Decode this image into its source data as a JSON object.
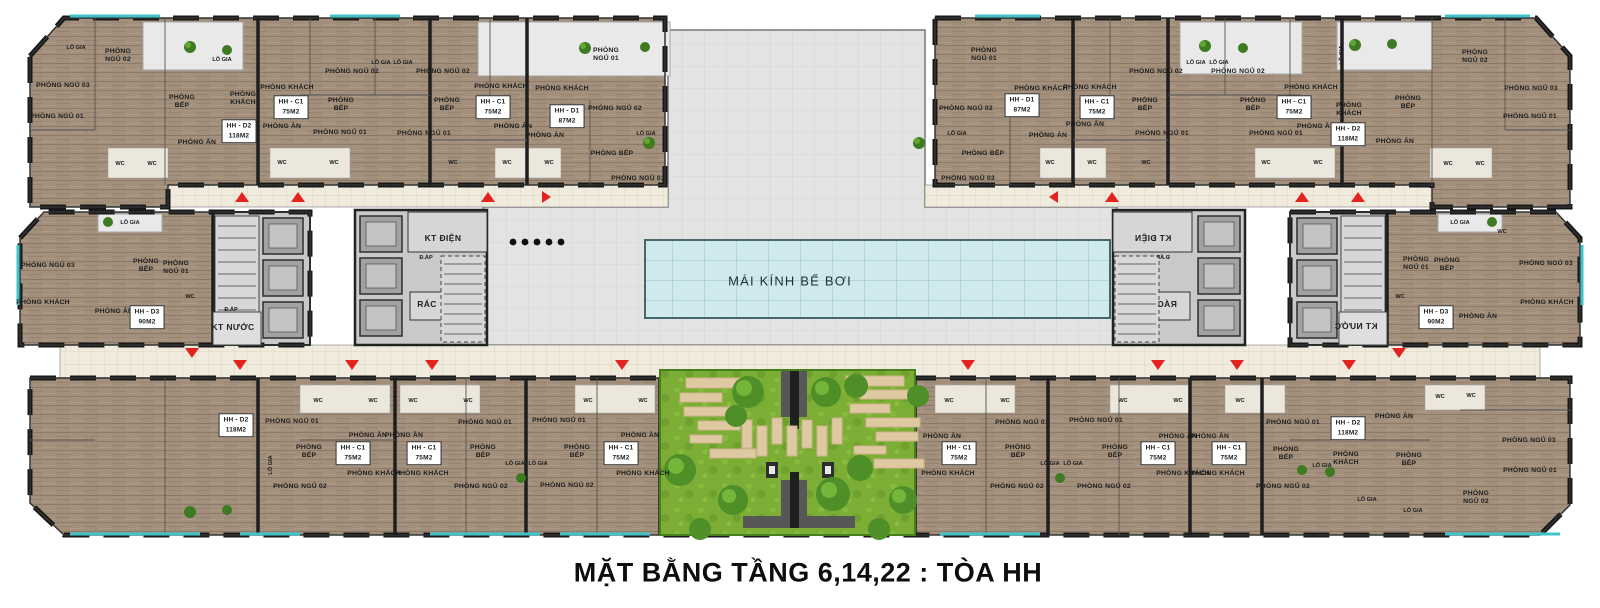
{
  "title": {
    "caption": "MẶT BẰNG TẦNG 6,14,22 : TÒA HH"
  },
  "building": "TÒA HH",
  "floors_shown": "6,14,22",
  "unit_types": [
    {
      "code": "HH - C1",
      "area": "75M2"
    },
    {
      "code": "HH - D1",
      "area": "87M2"
    },
    {
      "code": "HH - D2",
      "area": "118M2"
    },
    {
      "code": "HH - D3",
      "area": "90M2"
    }
  ],
  "colors": {
    "apartment_floor": "#a3907c",
    "corridor_tile": "#f0ebdc",
    "wall": "#1e1e1e",
    "deck": "#e3e3e4",
    "pool_glass": "#cfe9ec",
    "garden_grass": "#7cae35",
    "paver": "#dfc9a2",
    "balcony_accent": "#3fc3c8",
    "entrance_arrow": "#e42320",
    "core_floor": "#c9c9c9"
  },
  "labels": [
    {
      "t": "LÔ GIA",
      "x": 76,
      "y": 48,
      "s": "xs"
    },
    {
      "t": "PHÒNG\nNGỦ 02",
      "x": 118,
      "y": 56
    },
    {
      "t": "PHÒNG NGỦ 03",
      "x": 63,
      "y": 86
    },
    {
      "t": "PHÒNG NGỦ 01",
      "x": 57,
      "y": 117
    },
    {
      "t": "PHÒNG\nBẾP",
      "x": 182,
      "y": 102
    },
    {
      "t": "PHÒNG\nKHÁCH",
      "x": 243,
      "y": 99
    },
    {
      "t": "PHÒNG ĂN",
      "x": 197,
      "y": 143
    },
    {
      "t": "HH - D2\n118M2",
      "x": 239,
      "y": 131,
      "box": 1
    },
    {
      "t": "WC",
      "x": 120,
      "y": 164,
      "s": "xs"
    },
    {
      "t": "WC",
      "x": 152,
      "y": 164,
      "s": "xs"
    },
    {
      "t": "LÔ GIA",
      "x": 222,
      "y": 60,
      "s": "xs"
    },
    {
      "t": "PHÒNG KHÁCH",
      "x": 287,
      "y": 88
    },
    {
      "t": "HH - C1\n75M2",
      "x": 291,
      "y": 107,
      "box": 1
    },
    {
      "t": "PHÒNG ĂN",
      "x": 282,
      "y": 127
    },
    {
      "t": "PHÒNG\nBẾP",
      "x": 341,
      "y": 105
    },
    {
      "t": "PHÒNG NGỦ 02",
      "x": 352,
      "y": 72
    },
    {
      "t": "PHÒNG NGỦ 01",
      "x": 340,
      "y": 133
    },
    {
      "t": "LÔ GIA",
      "x": 381,
      "y": 63,
      "s": "xs"
    },
    {
      "t": "WC",
      "x": 282,
      "y": 163,
      "s": "xs"
    },
    {
      "t": "WC",
      "x": 334,
      "y": 163,
      "s": "xs"
    },
    {
      "t": "LÔ GIA",
      "x": 403,
      "y": 63,
      "s": "xs"
    },
    {
      "t": "PHÒNG NGỦ 02",
      "x": 443,
      "y": 72
    },
    {
      "t": "PHÒNG KHÁCH",
      "x": 501,
      "y": 87
    },
    {
      "t": "HH - C1\n75M2",
      "x": 493,
      "y": 107,
      "box": 1
    },
    {
      "t": "PHÒNG\nBẾP",
      "x": 447,
      "y": 105
    },
    {
      "t": "PHÒNG ĂN",
      "x": 513,
      "y": 127
    },
    {
      "t": "PHÒNG NGỦ 01",
      "x": 424,
      "y": 134
    },
    {
      "t": "WC",
      "x": 453,
      "y": 163,
      "s": "xs"
    },
    {
      "t": "WC",
      "x": 507,
      "y": 163,
      "s": "xs"
    },
    {
      "t": "WC",
      "x": 549,
      "y": 163,
      "s": "xs"
    },
    {
      "t": "PHÒNG KHÁCH",
      "x": 562,
      "y": 89
    },
    {
      "t": "HH - D1\n87M2",
      "x": 567,
      "y": 116,
      "box": 1
    },
    {
      "t": "PHÒNG ĂN",
      "x": 545,
      "y": 136
    },
    {
      "t": "PHÒNG\nNGỦ 01",
      "x": 606,
      "y": 55
    },
    {
      "t": "PHÒNG NGỦ 02",
      "x": 615,
      "y": 109
    },
    {
      "t": "LÔ GIA",
      "x": 646,
      "y": 134,
      "s": "xs"
    },
    {
      "t": "PHÒNG BẾP",
      "x": 612,
      "y": 154
    },
    {
      "t": "PHÒNG NGỦ 03",
      "x": 638,
      "y": 179
    },
    {
      "t": "PHÒNG\nNGỦ 01",
      "x": 984,
      "y": 55
    },
    {
      "t": "PHÒNG NGỦ 02",
      "x": 966,
      "y": 109
    },
    {
      "t": "PHÒNG BẾP",
      "x": 983,
      "y": 154
    },
    {
      "t": "PHÒNG NGỦ 03",
      "x": 968,
      "y": 179
    },
    {
      "t": "PHÒNG KHÁCH",
      "x": 1041,
      "y": 89
    },
    {
      "t": "HH - D1\n87M2",
      "x": 1022,
      "y": 105,
      "box": 1
    },
    {
      "t": "PHÒNG ĂN",
      "x": 1048,
      "y": 136
    },
    {
      "t": "LÔ GIA",
      "x": 957,
      "y": 134,
      "s": "xs"
    },
    {
      "t": "PHÒNG KHÁCH",
      "x": 1090,
      "y": 88
    },
    {
      "t": "HH - C1\n75M2",
      "x": 1097,
      "y": 107,
      "box": 1
    },
    {
      "t": "PHÒNG ĂN",
      "x": 1085,
      "y": 125
    },
    {
      "t": "PHÒNG NGỦ 02",
      "x": 1156,
      "y": 72
    },
    {
      "t": "PHÒNG\nBẾP",
      "x": 1145,
      "y": 105
    },
    {
      "t": "PHÒNG NGỦ 01",
      "x": 1162,
      "y": 134
    },
    {
      "t": "WC",
      "x": 1050,
      "y": 163,
      "s": "xs"
    },
    {
      "t": "WC",
      "x": 1092,
      "y": 163,
      "s": "xs"
    },
    {
      "t": "WC",
      "x": 1146,
      "y": 163,
      "s": "xs"
    },
    {
      "t": "LÔ GIA",
      "x": 1196,
      "y": 63,
      "s": "xs"
    },
    {
      "t": "PHÒNG NGỦ 02",
      "x": 1238,
      "y": 72
    },
    {
      "t": "PHÒNG\nBẾP",
      "x": 1253,
      "y": 105
    },
    {
      "t": "PHÒNG KHÁCH",
      "x": 1311,
      "y": 88
    },
    {
      "t": "HH - C1\n75M2",
      "x": 1294,
      "y": 107,
      "box": 1
    },
    {
      "t": "PHÒNG ĂN",
      "x": 1316,
      "y": 127
    },
    {
      "t": "PHÒNG NGỦ 01",
      "x": 1276,
      "y": 134
    },
    {
      "t": "WC",
      "x": 1266,
      "y": 163,
      "s": "xs"
    },
    {
      "t": "WC",
      "x": 1318,
      "y": 163,
      "s": "xs"
    },
    {
      "t": "LÔ GIA",
      "x": 1219,
      "y": 63,
      "s": "xs"
    },
    {
      "t": "PHÒNG\nKHÁCH",
      "x": 1349,
      "y": 110
    },
    {
      "t": "HH - D2\n118M2",
      "x": 1348,
      "y": 134,
      "box": 1
    },
    {
      "t": "PHÒNG ĂN",
      "x": 1395,
      "y": 142
    },
    {
      "t": "PHÒNG\nBẾP",
      "x": 1408,
      "y": 103
    },
    {
      "t": "PHÒNG\nNGỦ 02",
      "x": 1475,
      "y": 57
    },
    {
      "t": "PHÒNG NGỦ 03",
      "x": 1531,
      "y": 89
    },
    {
      "t": "PHÒNG NGỦ 01",
      "x": 1530,
      "y": 117
    },
    {
      "t": "WC",
      "x": 1448,
      "y": 164,
      "s": "xs"
    },
    {
      "t": "WC",
      "x": 1480,
      "y": 164,
      "s": "xs"
    },
    {
      "t": "LÔ GIA",
      "x": 1342,
      "y": 55,
      "s": "xs",
      "rot": 1
    },
    {
      "t": "LÔ GIA",
      "x": 130,
      "y": 223,
      "s": "xs"
    },
    {
      "t": "PHÒNG NGỦ 03",
      "x": 48,
      "y": 266
    },
    {
      "t": "PHÒNG KHÁCH",
      "x": 43,
      "y": 303
    },
    {
      "t": "PHÒNG\nBẾP",
      "x": 146,
      "y": 266
    },
    {
      "t": "PHÒNG\nNGỦ 01",
      "x": 176,
      "y": 268
    },
    {
      "t": "PHÒNG ĂN",
      "x": 114,
      "y": 312
    },
    {
      "t": "HH - D3\n90M2",
      "x": 147,
      "y": 317,
      "box": 1
    },
    {
      "t": "WC",
      "x": 190,
      "y": 297,
      "s": "xs"
    },
    {
      "t": "Đ.ÁP",
      "x": 231,
      "y": 310,
      "s": "xs"
    },
    {
      "t": "KT NƯỚC",
      "x": 233,
      "y": 328,
      "s": "sm"
    },
    {
      "t": "KT ĐIỆN",
      "x": 443,
      "y": 239,
      "s": "sm"
    },
    {
      "t": "Đ.ÁP",
      "x": 426,
      "y": 258,
      "s": "xs"
    },
    {
      "t": "RÁC",
      "x": 427,
      "y": 305,
      "s": "sm"
    },
    {
      "t": "KT ĐIỆN",
      "x": 1153,
      "y": 239,
      "s": "sm",
      "mir": 1
    },
    {
      "t": "Đ.ÁP",
      "x": 1163,
      "y": 258,
      "s": "xs",
      "mir": 1
    },
    {
      "t": "RÁC",
      "x": 1167,
      "y": 305,
      "s": "sm",
      "mir": 1
    },
    {
      "t": "KT NƯỚC",
      "x": 1356,
      "y": 327,
      "s": "sm",
      "mir": 1
    },
    {
      "t": "LÔ GIA",
      "x": 1460,
      "y": 223,
      "s": "xs"
    },
    {
      "t": "WC",
      "x": 1502,
      "y": 232,
      "s": "xs"
    },
    {
      "t": "PHÒNG\nNGỦ 01",
      "x": 1416,
      "y": 264
    },
    {
      "t": "PHÒNG\nBẾP",
      "x": 1447,
      "y": 265
    },
    {
      "t": "PHÒNG NGỦ 03",
      "x": 1546,
      "y": 264
    },
    {
      "t": "PHÒNG KHÁCH",
      "x": 1547,
      "y": 303
    },
    {
      "t": "PHÒNG ĂN",
      "x": 1478,
      "y": 317
    },
    {
      "t": "HH - D3\n90M2",
      "x": 1436,
      "y": 317,
      "box": 1
    },
    {
      "t": "WC",
      "x": 1400,
      "y": 297,
      "s": "xs"
    },
    {
      "t": "HH - D2\n118M2",
      "x": 236,
      "y": 425,
      "box": 1
    },
    {
      "t": "PHÒNG NGỦ 01",
      "x": 292,
      "y": 422
    },
    {
      "t": "WC",
      "x": 318,
      "y": 401,
      "s": "xs"
    },
    {
      "t": "WC",
      "x": 373,
      "y": 401,
      "s": "xs"
    },
    {
      "t": "PHÒNG\nBẾP",
      "x": 309,
      "y": 452
    },
    {
      "t": "PHÒNG NGỦ 02",
      "x": 300,
      "y": 487
    },
    {
      "t": "LÔ GIA",
      "x": 271,
      "y": 465,
      "s": "xs",
      "rot": 1
    },
    {
      "t": "HH - C1\n75M2",
      "x": 353,
      "y": 453,
      "box": 1
    },
    {
      "t": "PHÒNG ĂN",
      "x": 368,
      "y": 436
    },
    {
      "t": "PHÒNG KHÁCH",
      "x": 374,
      "y": 474
    },
    {
      "t": "PHÒNG ĂN",
      "x": 404,
      "y": 436
    },
    {
      "t": "WC",
      "x": 413,
      "y": 401,
      "s": "xs"
    },
    {
      "t": "WC",
      "x": 468,
      "y": 401,
      "s": "xs"
    },
    {
      "t": "PHÒNG NGỦ 01",
      "x": 485,
      "y": 423
    },
    {
      "t": "HH - C1\n75M2",
      "x": 424,
      "y": 453,
      "box": 1
    },
    {
      "t": "PHÒNG\nBẾP",
      "x": 483,
      "y": 452
    },
    {
      "t": "LÔ GIA",
      "x": 515,
      "y": 464,
      "s": "xs"
    },
    {
      "t": "LÔ GIA",
      "x": 538,
      "y": 464,
      "s": "xs"
    },
    {
      "t": "PHÒNG NGỦ 02",
      "x": 481,
      "y": 487
    },
    {
      "t": "PHÒNG KHÁCH",
      "x": 422,
      "y": 474
    },
    {
      "t": "PHÒNG NGỦ 01",
      "x": 559,
      "y": 421
    },
    {
      "t": "PHÒNG\nBẾP",
      "x": 577,
      "y": 452
    },
    {
      "t": "HH - C1\n75M2",
      "x": 621,
      "y": 453,
      "box": 1
    },
    {
      "t": "PHÒNG ĂN",
      "x": 640,
      "y": 436
    },
    {
      "t": "PHÒNG KHÁCH",
      "x": 643,
      "y": 474
    },
    {
      "t": "PHÒNG NGỦ 02",
      "x": 567,
      "y": 486
    },
    {
      "t": "WC",
      "x": 588,
      "y": 401,
      "s": "xs"
    },
    {
      "t": "WC",
      "x": 643,
      "y": 401,
      "s": "xs"
    },
    {
      "t": "PHÒNG ĂN",
      "x": 942,
      "y": 437
    },
    {
      "t": "PHÒNG KHÁCH",
      "x": 948,
      "y": 474
    },
    {
      "t": "HH - C1\n75M2",
      "x": 959,
      "y": 453,
      "box": 1
    },
    {
      "t": "WC",
      "x": 949,
      "y": 401,
      "s": "xs"
    },
    {
      "t": "WC",
      "x": 1005,
      "y": 401,
      "s": "xs"
    },
    {
      "t": "PHÒNG NGỦ 01",
      "x": 1022,
      "y": 423
    },
    {
      "t": "PHÒNG\nBẾP",
      "x": 1018,
      "y": 452
    },
    {
      "t": "LÔ GIA",
      "x": 1050,
      "y": 464,
      "s": "xs"
    },
    {
      "t": "LÔ GIA",
      "x": 1073,
      "y": 464,
      "s": "xs"
    },
    {
      "t": "PHÒNG NGỦ 02",
      "x": 1017,
      "y": 487
    },
    {
      "t": "PHÒNG NGỦ 01",
      "x": 1096,
      "y": 421
    },
    {
      "t": "PHÒNG\nBẾP",
      "x": 1115,
      "y": 452
    },
    {
      "t": "HH - C1\n75M2",
      "x": 1158,
      "y": 453,
      "box": 1
    },
    {
      "t": "PHÒNG ĂN",
      "x": 1178,
      "y": 437
    },
    {
      "t": "PHÒNG KHÁCH",
      "x": 1183,
      "y": 474
    },
    {
      "t": "PHÒNG NGỦ 02",
      "x": 1104,
      "y": 487
    },
    {
      "t": "WC",
      "x": 1123,
      "y": 401,
      "s": "xs"
    },
    {
      "t": "WC",
      "x": 1178,
      "y": 401,
      "s": "xs"
    },
    {
      "t": "PHÒNG ĂN",
      "x": 1210,
      "y": 437
    },
    {
      "t": "PHÒNG KHÁCH",
      "x": 1218,
      "y": 474
    },
    {
      "t": "HH - C1\n75M2",
      "x": 1229,
      "y": 453,
      "box": 1
    },
    {
      "t": "WC",
      "x": 1240,
      "y": 401,
      "s": "xs"
    },
    {
      "t": "PHÒNG NGỦ 01",
      "x": 1293,
      "y": 423
    },
    {
      "t": "HH - D2\n118M2",
      "x": 1348,
      "y": 428,
      "box": 1
    },
    {
      "t": "PHÒNG ĂN",
      "x": 1394,
      "y": 417
    },
    {
      "t": "PHÒNG\nBẾP",
      "x": 1286,
      "y": 454
    },
    {
      "t": "PHÒNG\nKHÁCH",
      "x": 1346,
      "y": 459
    },
    {
      "t": "PHÒNG\nBẾP",
      "x": 1409,
      "y": 460
    },
    {
      "t": "PHÒNG NGỦ 02",
      "x": 1283,
      "y": 487
    },
    {
      "t": "LÔ GIA",
      "x": 1322,
      "y": 466,
      "s": "xs"
    },
    {
      "t": "LÔ GIA",
      "x": 1367,
      "y": 500,
      "s": "xs"
    },
    {
      "t": "LÔ GIA",
      "x": 1413,
      "y": 511,
      "s": "xs"
    },
    {
      "t": "PHÒNG\nNGỦ 02",
      "x": 1476,
      "y": 498
    },
    {
      "t": "PHÒNG NGỦ 03",
      "x": 1529,
      "y": 441
    },
    {
      "t": "PHÒNG NGỦ 01",
      "x": 1530,
      "y": 471
    },
    {
      "t": "WC",
      "x": 1440,
      "y": 397,
      "s": "xs"
    },
    {
      "t": "WC",
      "x": 1471,
      "y": 396,
      "s": "xs"
    },
    {
      "t": "MÁI KÍNH BỂ BƠI",
      "x": 790,
      "y": 282,
      "s": "pool"
    }
  ]
}
